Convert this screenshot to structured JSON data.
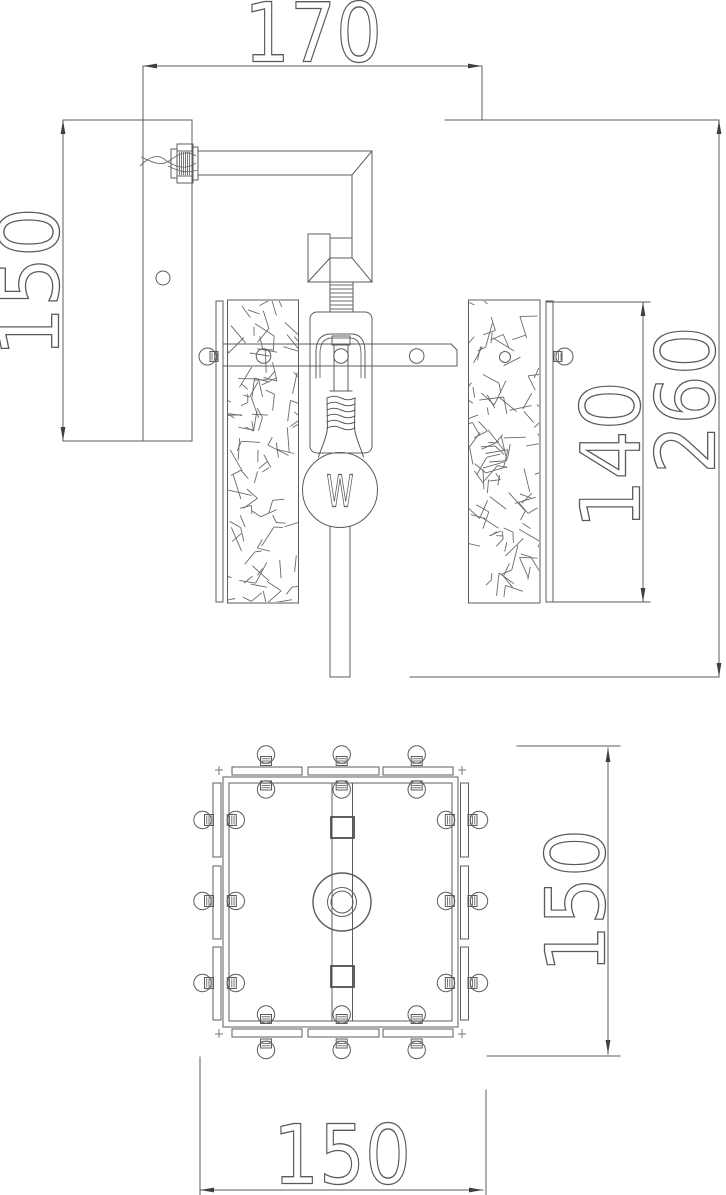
{
  "front_view": {
    "dim_width_top": "170",
    "dim_height_left": "150",
    "dim_glass_panel_height": "140",
    "dim_overall_height": "260",
    "bulb_filament_mark": "W"
  },
  "plan_view": {
    "dim_depth_right": "150",
    "dim_width_bottom": "150"
  },
  "colors": {
    "background": "#ffffff",
    "line": "#5c5c5c",
    "dimension_text": "#5a5a5a",
    "arrow": "#3f3f3f"
  }
}
